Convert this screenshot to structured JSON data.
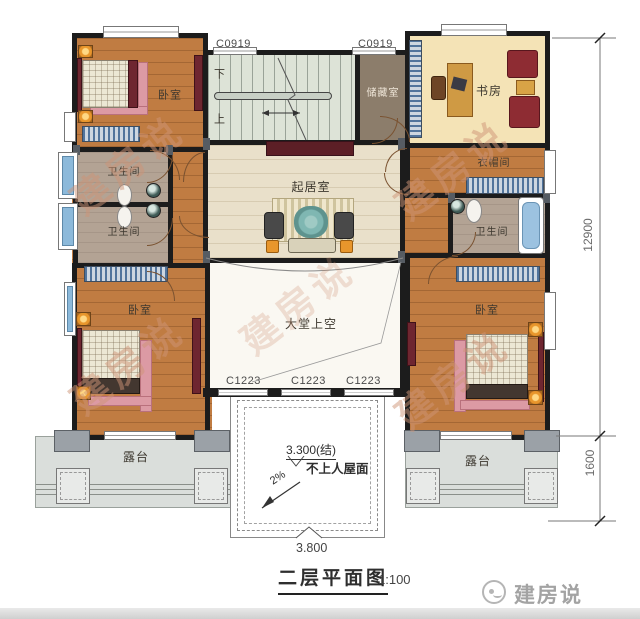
{
  "title_block": {
    "title": "二层平面图",
    "scale": "1:100"
  },
  "brand": {
    "logo_text": "建房说",
    "watermark": "建房说"
  },
  "labels": {
    "bedroom_tl": "卧室",
    "bedroom_bl": "卧室",
    "bedroom_br": "卧室",
    "bath_left_top": "卫生间",
    "bath_left_bottom": "卫生间",
    "bath_right": "卫生间",
    "living": "起居室",
    "storage": "储藏室",
    "study": "书房",
    "cloakroom": "衣帽间",
    "hall_void": "大堂上空",
    "terrace_left": "露台",
    "terrace_right": "露台",
    "stairs_down": "下",
    "stairs_up": "上",
    "roof_area": "不上人屋面",
    "roof_elevation": "3.300(结)",
    "roof_slope": "2%"
  },
  "window_labels": {
    "top_left": "C0919",
    "top_right": "C0919",
    "bottom": [
      "C1223",
      "C1223",
      "C1223"
    ]
  },
  "dimensions": {
    "overall_height": "12900",
    "terrace_depth": "1600",
    "entry_width": "3.800"
  }
}
